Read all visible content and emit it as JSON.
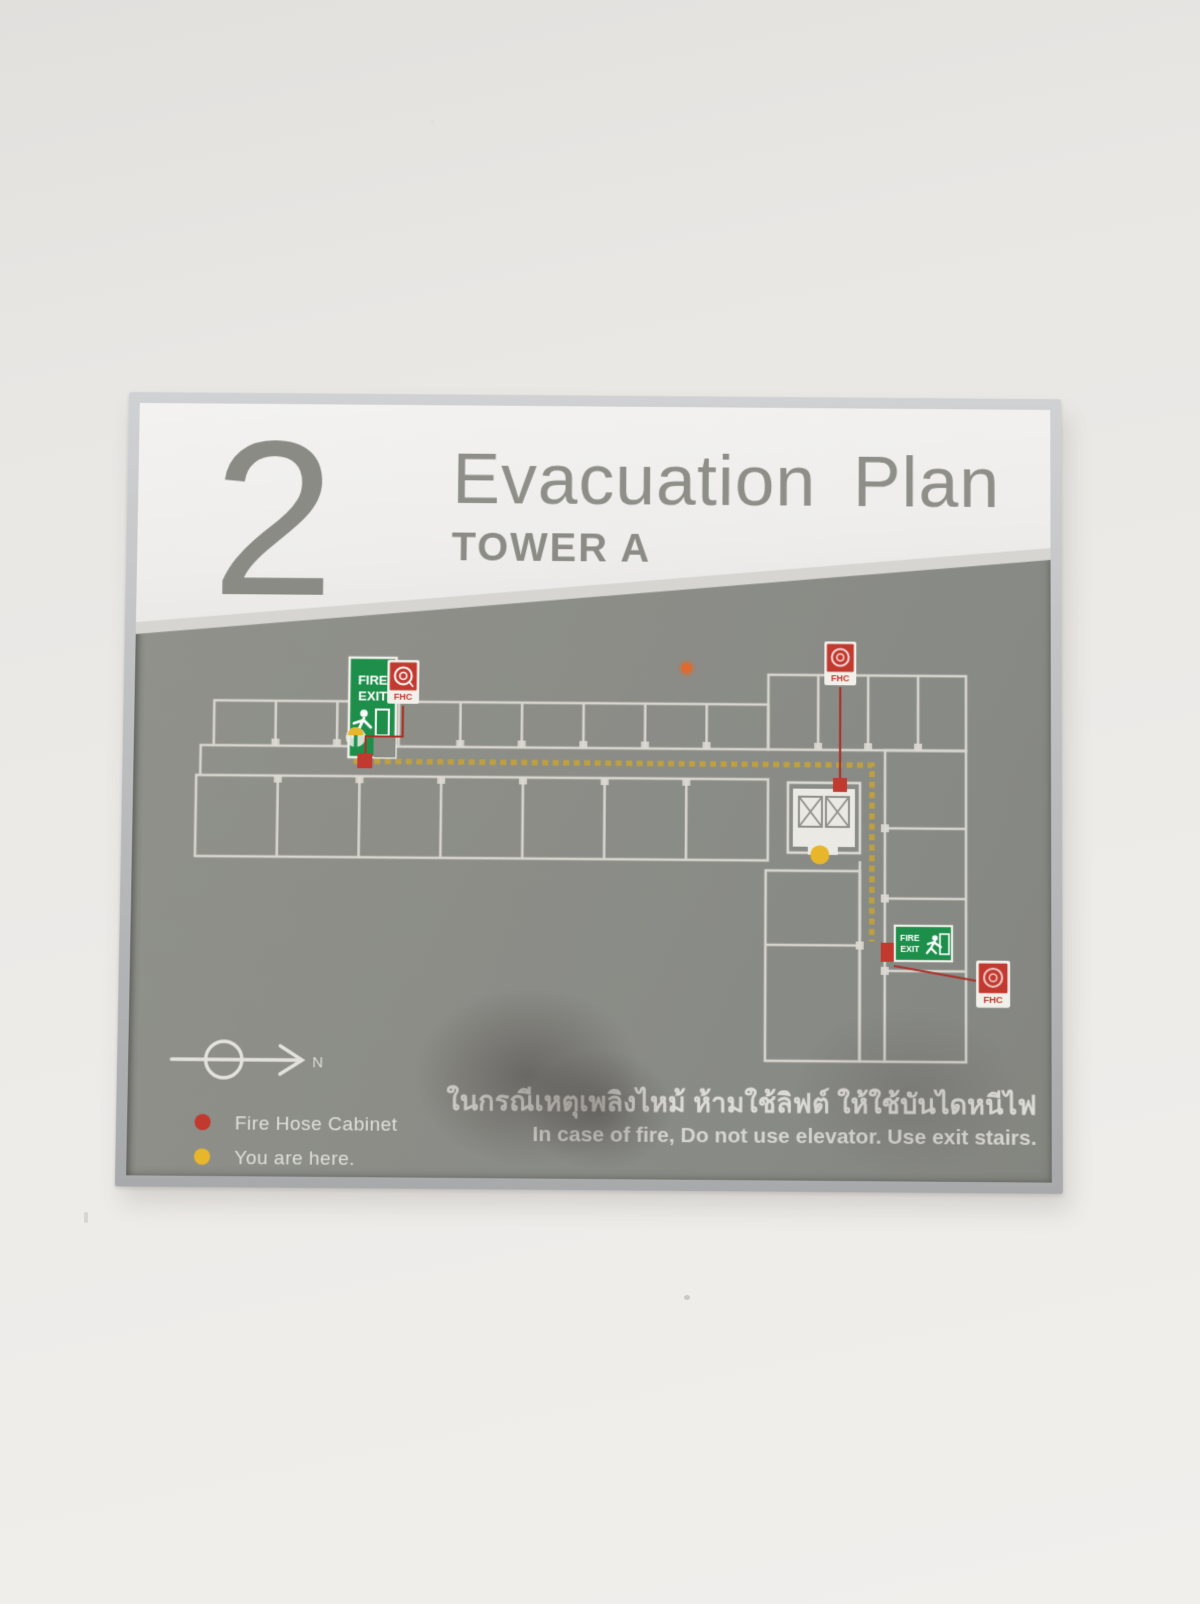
{
  "sign": {
    "header": {
      "floor_number": "2",
      "title": "Evacuation Plan",
      "subtitle": "TOWER A"
    },
    "map": {
      "fire_exit_main": {
        "line1": "FIRE",
        "line2": "EXIT"
      },
      "fire_exit_secondary": {
        "line1": "FIRE",
        "line2": "EXIT"
      },
      "fhc_label": "FHC",
      "north_label": "N"
    },
    "legend": {
      "items": [
        {
          "label": "Fire Hose Cabinet",
          "color": "#c2392f"
        },
        {
          "label": "You are here.",
          "color": "#e8b62a"
        }
      ]
    },
    "notice": {
      "thai": "ในกรณีเหตุเพลิงไหม้ ห้ามใช้ลิฟต์ ให้ใช้บันไดหนีไฟ",
      "english": "In case of fire, Do not use elevator. Use exit stairs."
    },
    "colors": {
      "panel_gray": "#8c8d87",
      "accent_red": "#c2392f",
      "exit_green": "#1d8f4b",
      "route_gold": "#c2a23a",
      "marker_yellow": "#e8b62a"
    }
  }
}
